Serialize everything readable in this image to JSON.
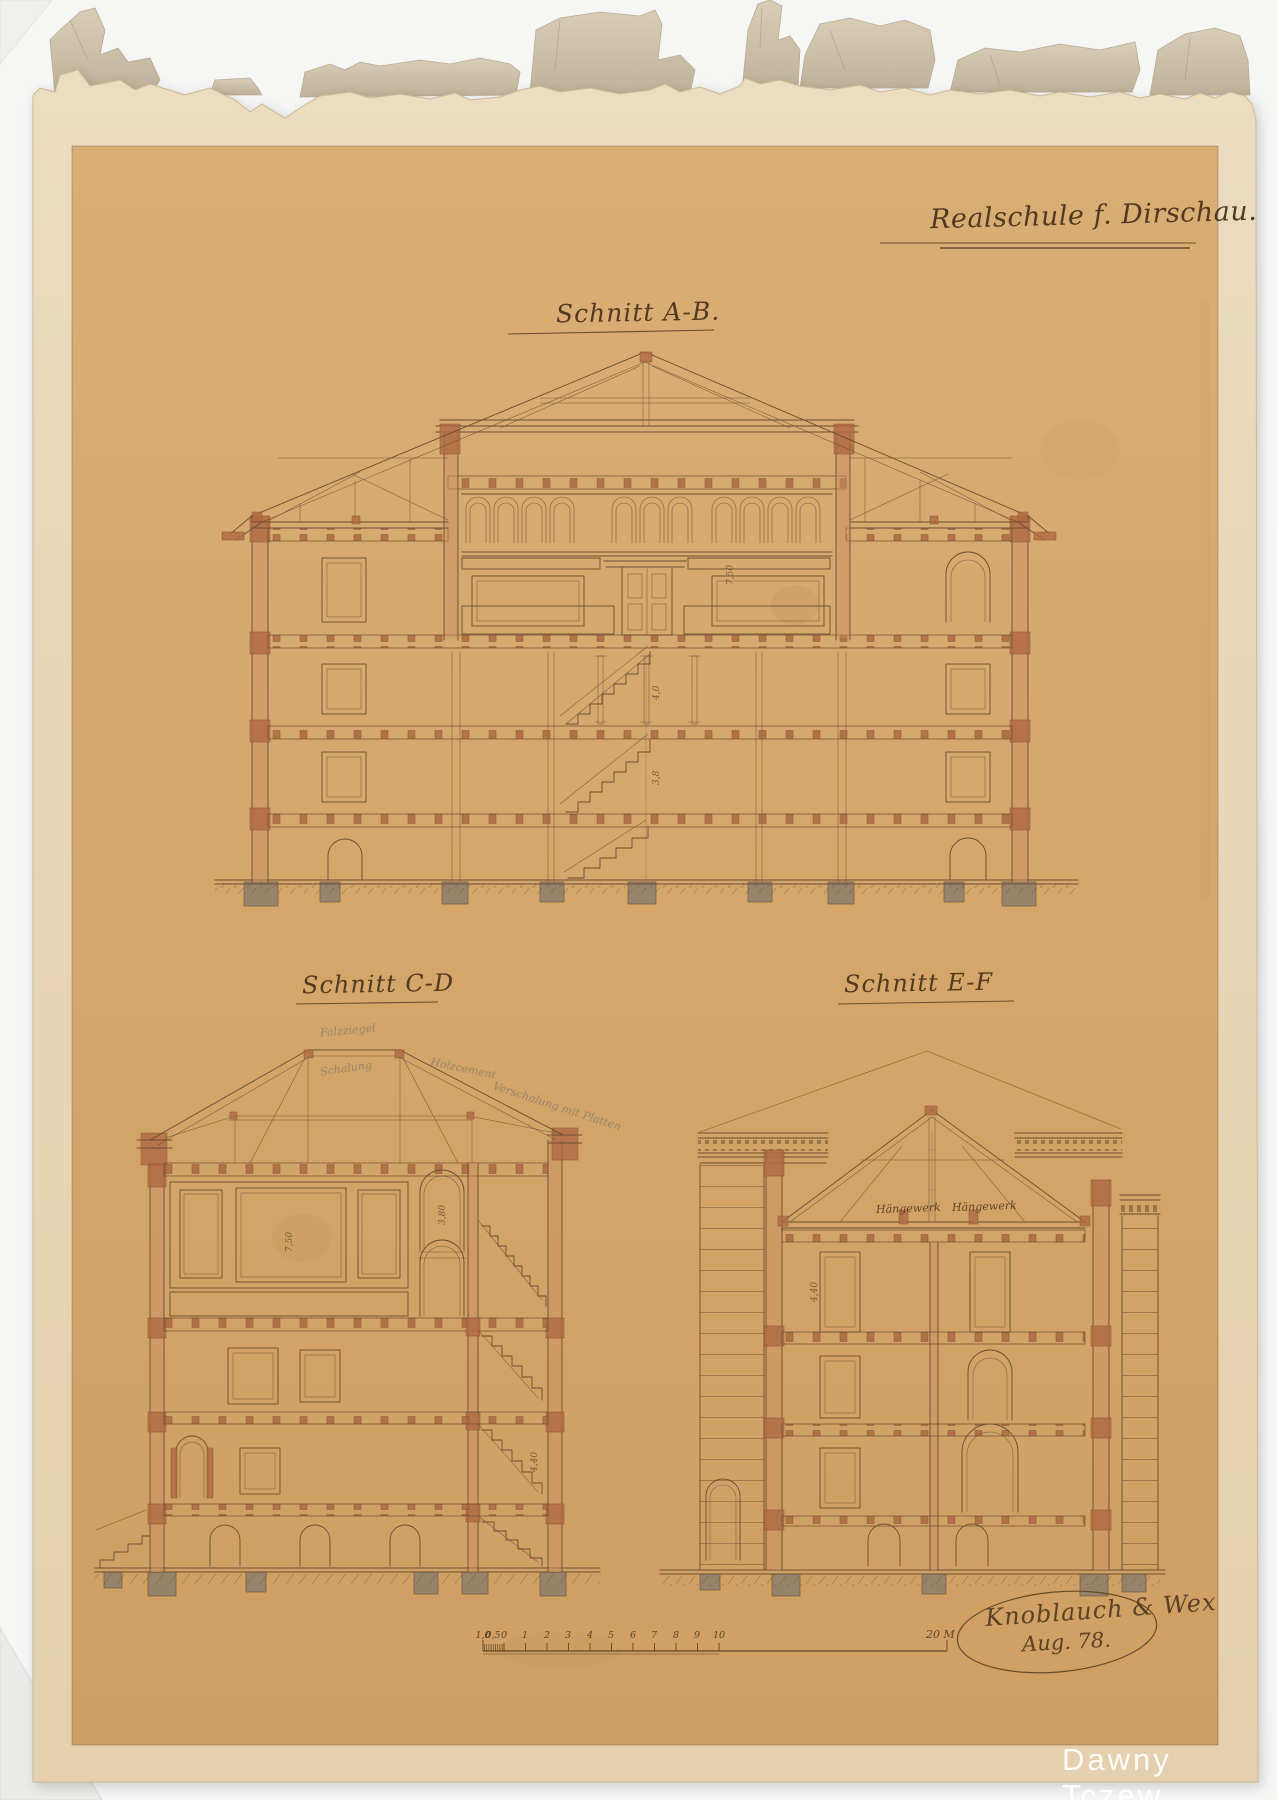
{
  "artifact": {
    "title": "Realschule f. Dirschau.",
    "sections": {
      "ab": "Schnitt A-B.",
      "cd": "Schnitt C-D",
      "ef": "Schnitt E-F"
    },
    "annotations": {
      "haengewerk_left": "Hängewerk",
      "haengewerk_right": "Hängewerk",
      "pencil_notes": [
        "Falzziegel",
        "Schalung",
        "Holzcement",
        "Verschalung mit Platten"
      ],
      "dimensions": {
        "ab_right": "7,50",
        "ab_mid_upper": "4,0",
        "ab_mid_lower": "3,8",
        "cd_panel": "7,50",
        "cd_corridor": "3,80",
        "cd_stairs": "4,40",
        "ef_left": "4,40"
      }
    },
    "scale_bar": {
      "tick_labels": [
        "1,0",
        "0,5",
        "0",
        "1",
        "2",
        "3",
        "4",
        "5",
        "6",
        "7",
        "8",
        "9",
        "10"
      ],
      "end_label": "20 M"
    },
    "signature": {
      "line1": "Knoblauch & Wex",
      "line2": "Aug. 78."
    },
    "watermark": "Dawny Tczew",
    "colors": {
      "background": "#f6f6f5",
      "paper_margin": "#e9d8ba",
      "paper_drawing": "#d5a76c",
      "ink": "#6b4e31",
      "wash_red": "#b06a43",
      "wash_gray": "#8d7e6b",
      "watermark": "#ffffff"
    }
  }
}
